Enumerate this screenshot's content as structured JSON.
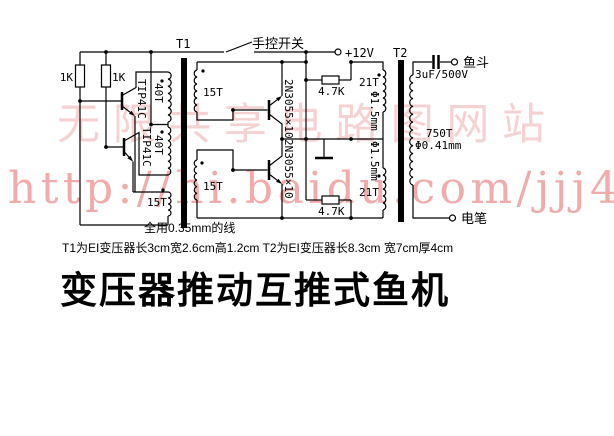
{
  "title": "变压器推动互推式鱼机",
  "watermark": {
    "line1": "无限共享电路图网站",
    "line2": "http://hi.baidu.com/jjj4"
  },
  "power": {
    "terminal": "+12V"
  },
  "switch": {
    "label": "手控开关"
  },
  "transformer_t1": {
    "name": "T1",
    "primary_winding_1": "40T",
    "primary_winding_2": "40T",
    "feedback_winding": "15T",
    "secondary_winding_1": "15T",
    "secondary_winding_2": "15T"
  },
  "transformer_t2": {
    "name": "T2",
    "primary_winding_1": "21T",
    "primary_winding_2": "21T",
    "primary_wire_gauge_1": "Φ1.5mm",
    "primary_wire_gauge_2": "Φ1.5mm",
    "secondary_winding": "750T",
    "secondary_wire_gauge": "Φ0.41mm"
  },
  "components": {
    "bias_resistor_1": "1K",
    "bias_resistor_2": "1K",
    "driver_transistor_1": "TIP41C",
    "driver_transistor_2": "TIP41C",
    "power_transistor_1": "2N3055×10",
    "power_transistor_2": "2N3055×10",
    "damping_resistor_1": "4.7K",
    "damping_resistor_2": "4.7K",
    "output_capacitor": "3uF/500V"
  },
  "outputs": {
    "fish_bucket": "鱼斗",
    "electric_pen": "电笔"
  },
  "notes": {
    "wire_note": "全用0.35mm的线",
    "transformer_note": "T1为EI变压器长3cm宽2.6cm高1.2cm  T2为EI变压器长8.3cm 宽7cm厚4cm"
  }
}
